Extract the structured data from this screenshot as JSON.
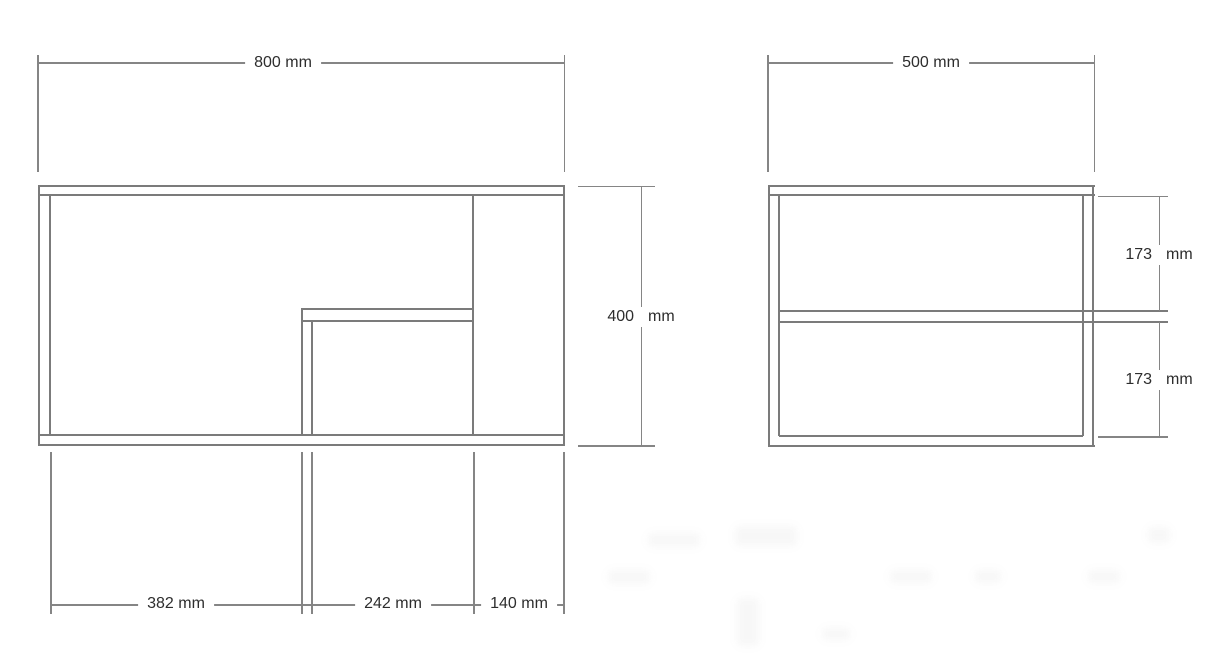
{
  "drawing": {
    "type": "technical-dimension-drawing",
    "background": "#ffffff",
    "line_color": "#7b7b7b",
    "text_color": "#2d2d2d",
    "unit": "mm",
    "views": [
      {
        "id": "front",
        "overall_width_mm": 800,
        "overall_height_mm": 400,
        "bottom_section_widths_mm": [
          382,
          242,
          140
        ]
      },
      {
        "id": "side",
        "overall_width_mm": 500,
        "shelf_gap_heights_mm": [
          173,
          173
        ]
      }
    ]
  },
  "labels": {
    "dim_800": "800 mm",
    "dim_500": "500 mm",
    "dim_400_value": "400",
    "dim_400_unit": "mm",
    "dim_382": "382 mm",
    "dim_242": "242 mm",
    "dim_140": "140 mm",
    "dim_173_top_value": "173",
    "dim_173_top_unit": "mm",
    "dim_173_bottom_value": "173",
    "dim_173_bottom_unit": "mm"
  }
}
